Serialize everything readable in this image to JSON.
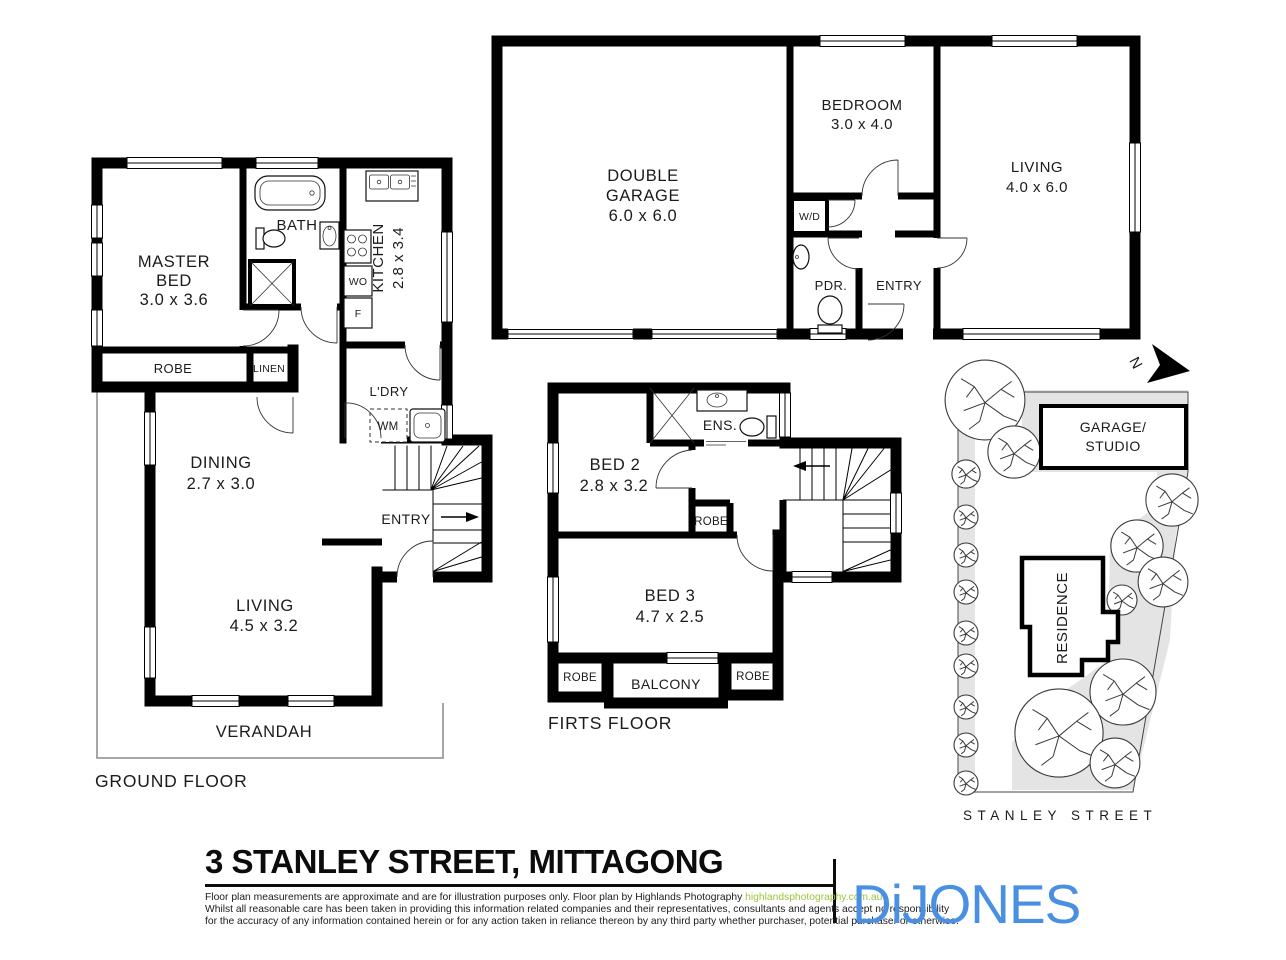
{
  "colors": {
    "wall": "#000000",
    "site_fill": "#e4e4e4",
    "brand_blue": "#4a90e2",
    "link_green": "#9bc53d"
  },
  "plan": {
    "ground": {
      "floor_label": "GROUND FLOOR",
      "master_line1": "MASTER",
      "master_line2": "BED",
      "master_dims": "3.0 x 3.6",
      "bath": "BATH",
      "kitchen": "KITCHEN",
      "kitchen_dims": "2.8 x 3.4",
      "wall_oven": "WO",
      "fridge": "F",
      "robe": "ROBE",
      "linen": "LINEN",
      "laundry": "L'DRY",
      "washing_machine": "WM",
      "dining": "DINING",
      "dining_dims": "2.7 x 3.0",
      "entry": "ENTRY",
      "living": "LIVING",
      "living_dims": "4.5 x 3.2",
      "verandah": "VERANDAH"
    },
    "garage_level": {
      "garage_line1": "DOUBLE",
      "garage_line2": "GARAGE",
      "garage_dims": "6.0 x 6.0",
      "bedroom": "BEDROOM",
      "bedroom_dims": "3.0 x 4.0",
      "living": "LIVING",
      "living_dims": "4.0 x 6.0",
      "washer_dryer": "W/D",
      "powder": "PDR.",
      "entry": "ENTRY"
    },
    "first": {
      "floor_label": "FIRTS FLOOR",
      "bed2": "BED 2",
      "bed2_dims": "2.8 x 3.2",
      "ensuite": "ENS.",
      "robe_bed2": "ROBE",
      "bed3": "BED 3",
      "bed3_dims": "4.7 x 2.5",
      "robe_left": "ROBE",
      "balcony": "BALCONY",
      "robe_right": "ROBE"
    },
    "site": {
      "north": "N",
      "garage_studio_line1": "GARAGE/",
      "garage_studio_line2": "STUDIO",
      "residence": "RESIDENCE",
      "street": "STANLEY STREET"
    }
  },
  "footer": {
    "title": "3 STANLEY STREET, MITTAGONG",
    "disclaimer_line1": "Floor plan measurements are approximate and are for illustration purposes only. Floor plan by Highlands Photography ",
    "disclaimer_link": "highlandsphotography.com.au",
    "disclaimer_line2": "Whilst all reasonable care has been taken in providing this information related companies and their representatives, consultants and agents accept no responsibility",
    "disclaimer_line3": "for the accuracy of any information contained herein or for any action taken in reliance thereon by any third party whether purchaser, potential purchaser or otherwise.",
    "brand": "DiJONES"
  }
}
